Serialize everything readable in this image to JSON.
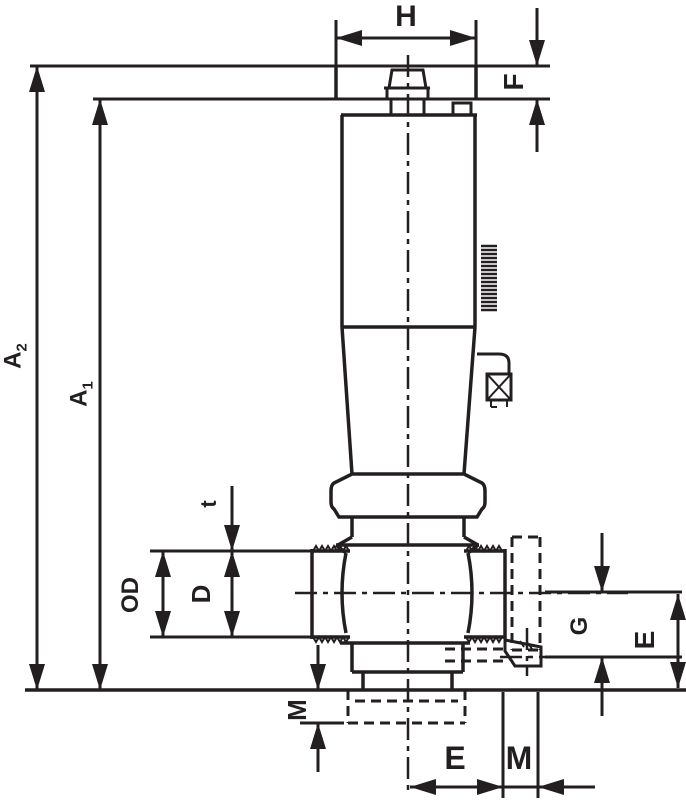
{
  "drawing": {
    "kind": "technical-dimension-drawing",
    "component": "threaded-valve-with-handle-side-view",
    "line_color": "#231f20",
    "background_color": "#ffffff"
  },
  "labels": {
    "h": "H",
    "f": "F",
    "a2": {
      "main": "A",
      "sub": "2"
    },
    "a1": {
      "main": "A",
      "sub": "1"
    },
    "t": "t",
    "od": "OD",
    "d": "D",
    "g": "G",
    "e_right": "E",
    "m_left": "M",
    "e_bottom": "E",
    "m_bottom": "M"
  }
}
